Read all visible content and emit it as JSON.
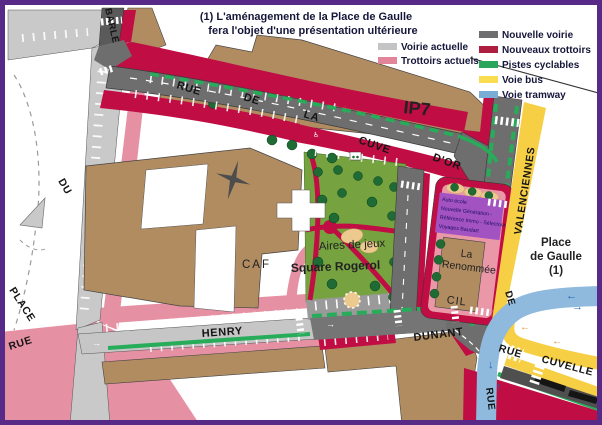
{
  "title": {
    "line1": "(1) L'aménagement de la Place de Gaulle",
    "line2": "fera l'objet d'une présentation ultérieure"
  },
  "legend": {
    "current": [
      {
        "label": "Voirie actuelle",
        "color": "#c4c4c6"
      },
      {
        "label": "Trottoirs actuels",
        "color": "#e2849a"
      }
    ],
    "new": [
      {
        "label": "Nouvelle voirie",
        "color": "#6e6e70"
      },
      {
        "label": "Nouveaux trottoirs",
        "color": "#ae1e3f"
      },
      {
        "label": "Pistes cyclables",
        "color": "#2aa65a"
      },
      {
        "label": "Voie bus",
        "color": "#f9dc4f"
      },
      {
        "label": "Voie tramway",
        "color": "#79add5"
      }
    ]
  },
  "streets": {
    "barle": "BARLE",
    "rue_de_la": {
      "rue": "RUE",
      "de": "DE",
      "la": "LA",
      "cuve": "CUVE",
      "dor": "D'OR"
    },
    "valenciennes": "VALENCIENNES",
    "place": "PLACE",
    "du": "DU",
    "rue_left": "RUE",
    "henry": "HENRY",
    "dunant": "DUNANT",
    "de_vertical": "DE",
    "rue_cuvelle": {
      "rue": "RUE",
      "cuvelle": "CUVELLE"
    },
    "rue_tram": "RUE"
  },
  "areas": {
    "ip7": "IP7",
    "caf": "CAF",
    "aires_de_jeux": "Aires de jeux",
    "square_rogerol": "Square Rogerol",
    "la_renommee": [
      "La",
      "Renommée"
    ],
    "cil": "CIL",
    "place_de_gaulle": [
      "Place",
      "de Gaulle",
      "(1)"
    ]
  },
  "shops": [
    "Auto école",
    "Nouvelle Génération -",
    "Référence Immo - Sélectour",
    "Voyages Baudart"
  ],
  "icons": {
    "arrow_left": "←",
    "arrow_right": "→",
    "arrow_down": "↓",
    "arrow_up": "↑",
    "wheelchair": "♿"
  },
  "colors": {
    "frame": "#562a86",
    "old_road": "#c9c9c9",
    "old_sidewalk": "#e691a3",
    "new_road": "#6e6e6e",
    "new_sidewalk": "#c00d43",
    "cycle": "#27ad59",
    "bus": "#f6cf45",
    "tram": "#8fb9dd",
    "park": "#76a340",
    "building": "#b08c60",
    "tree": "#1e6b34",
    "shops_box": "#a352c2",
    "playground": "#ecc98f"
  }
}
